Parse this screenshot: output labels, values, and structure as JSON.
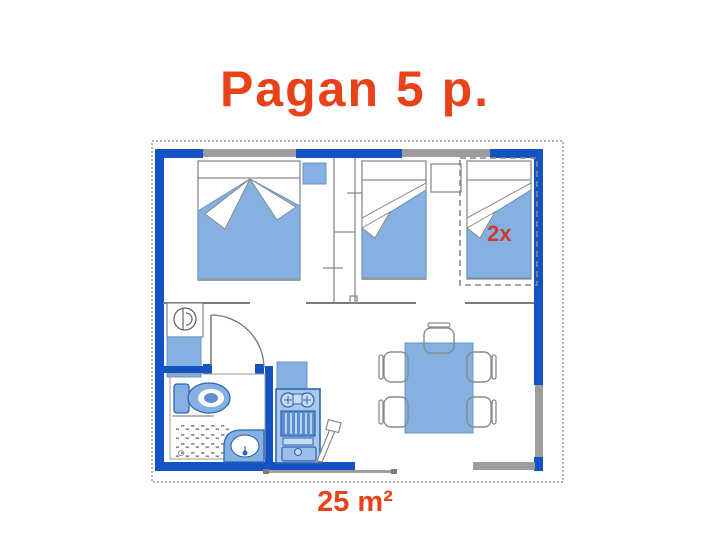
{
  "title": "Pagan 5 p.",
  "area_label": "25 m²",
  "floor_plan": {
    "bunk_label": "2x",
    "colors": {
      "title_red": "#e8421a",
      "bunk_label_red": "#cc3b2e",
      "wall_blue": "#1353c4",
      "furniture_blue": "#84b1e1",
      "kitchen_blue": "#a8c8ec",
      "window_gray": "#9d9d9d"
    },
    "icons": [
      "double-bed-icon",
      "single-bed-icon",
      "bunk-bed-icon",
      "nightstand-icon",
      "wardrobe-wall-icon",
      "water-heater-icon",
      "toilet-icon",
      "shower-icon",
      "washbasin-icon",
      "kitchen-unit-icon",
      "dining-table-icon",
      "chair-icon",
      "door-swing-icon",
      "window-icon"
    ]
  }
}
